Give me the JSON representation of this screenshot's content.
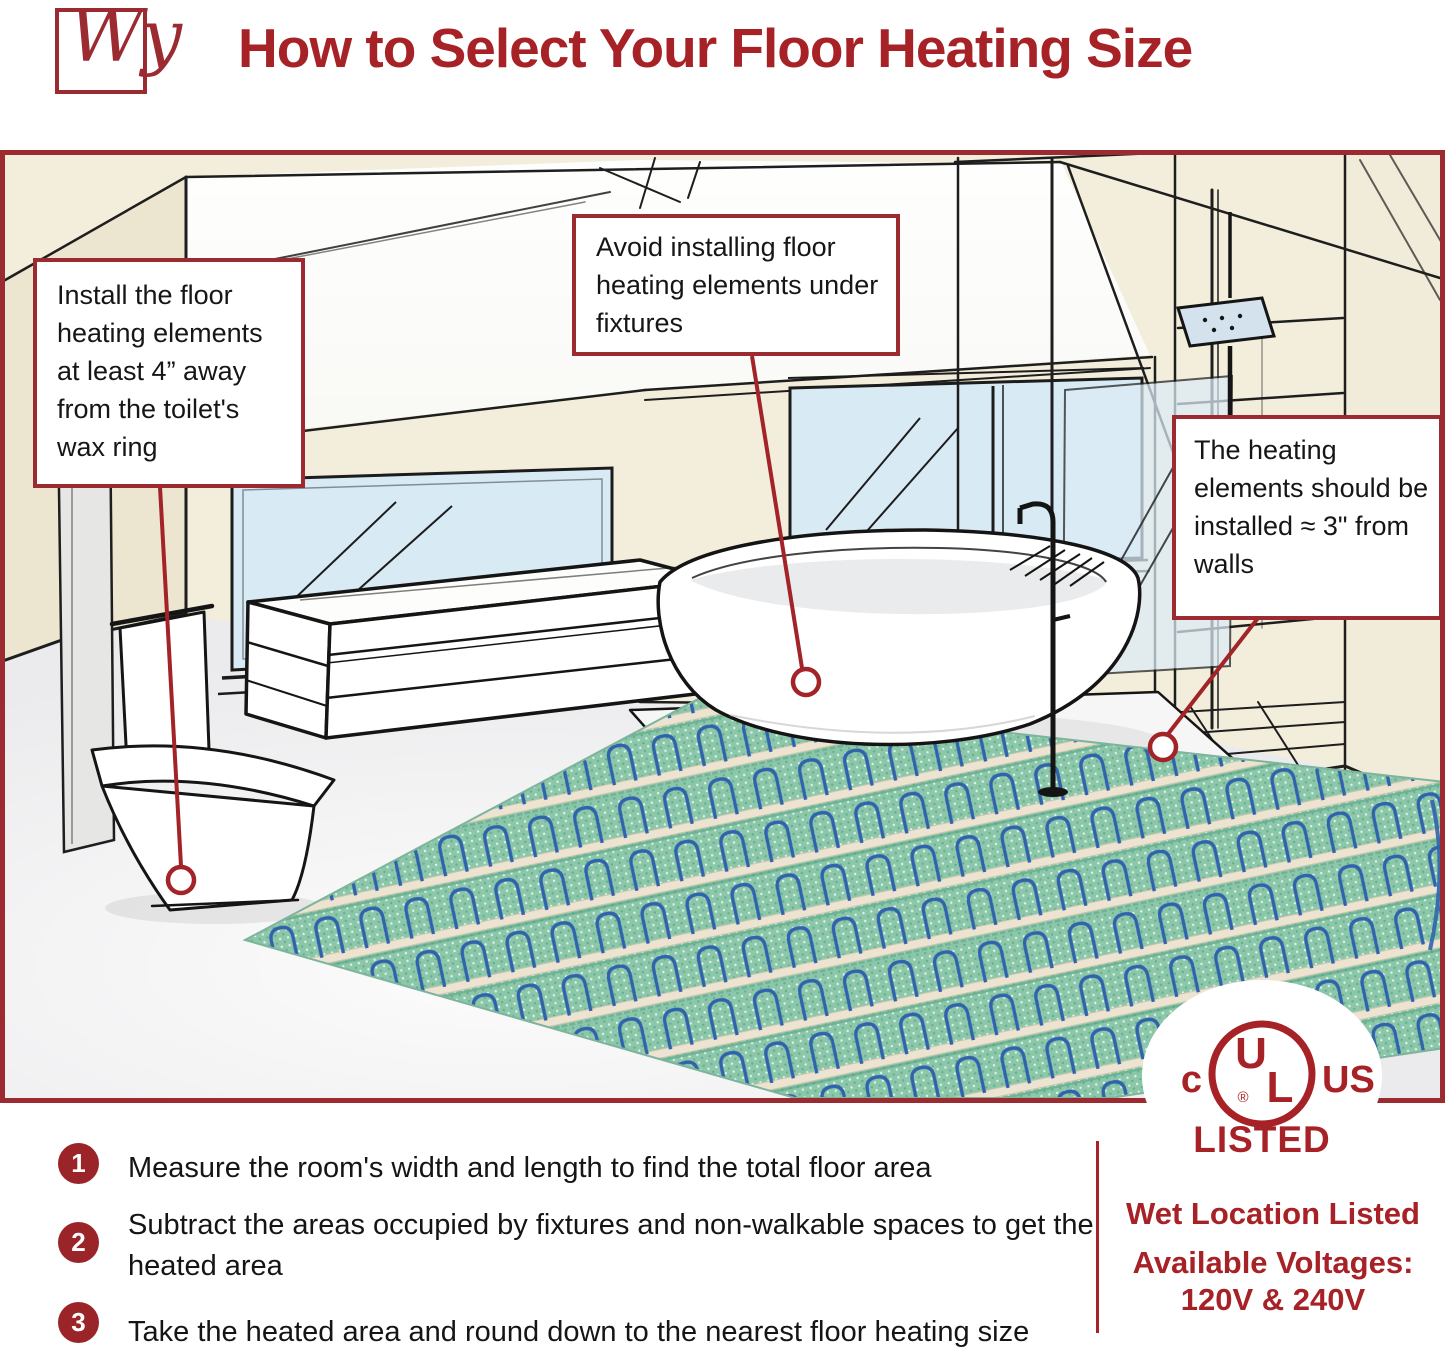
{
  "header": {
    "logo_text": "Wy",
    "title": "How to Select Your Floor Heating Size"
  },
  "colors": {
    "accent_red": "#a72227",
    "border_red": "#9b2b31",
    "wall_cream": "#f3eedb",
    "window_blue": "#d8eaf4",
    "floor_gray": "#ebebed",
    "mat_green": "#8cc7aa",
    "cable_blue": "#3163ac",
    "text_black": "#151515"
  },
  "callouts": {
    "toilet": "Install the floor heating elements at least 4” away from the toilet's wax ring",
    "fixtures": "Avoid installing floor heating elements under fixtures",
    "walls": "The heating elements should be installed ≈ 3\" from walls"
  },
  "steps": [
    {
      "number": "1",
      "text": "Measure the room's width and length to find the total floor area"
    },
    {
      "number": "2",
      "text": "Subtract the areas occupied by fixtures and non-walkable spaces to get the heated area"
    },
    {
      "number": "3",
      "text": "Take the heated area and round down to the nearest floor heating size"
    }
  ],
  "certification": {
    "ul_left": "c",
    "ul_letter_u": "U",
    "ul_letter_l": "L",
    "ul_registered": "®",
    "ul_right": "US",
    "listed": "LISTED",
    "wet_location": "Wet Location Listed",
    "voltages_label": "Available Voltages:",
    "voltages_value": "120V & 240V"
  }
}
